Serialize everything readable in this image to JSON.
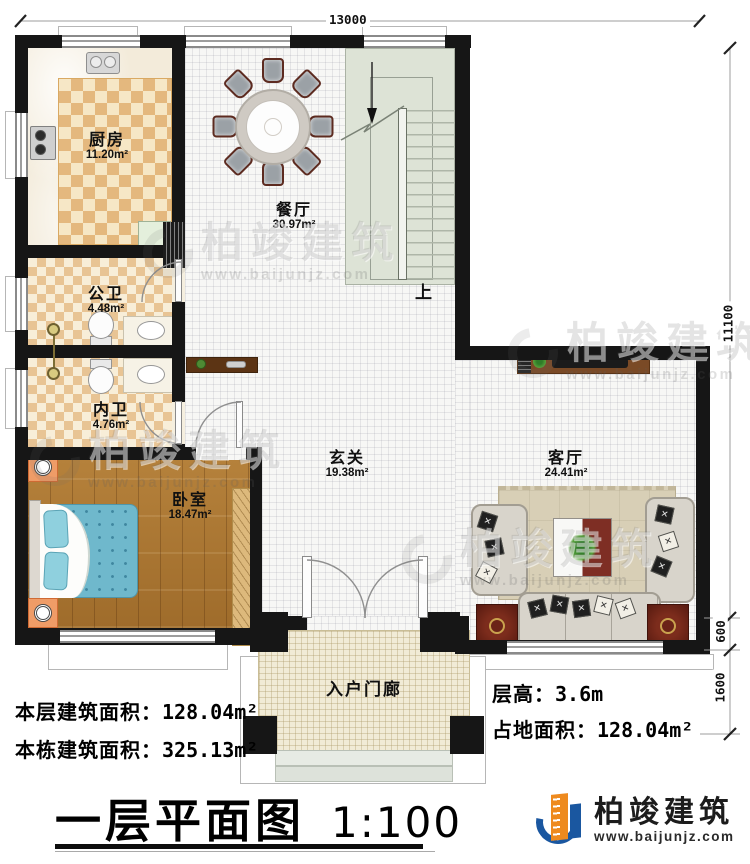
{
  "plan": {
    "title": "一层平面图",
    "scale": "1:100",
    "stair_label": "上",
    "rooms": [
      {
        "name": "厨房",
        "area": "11.20m²"
      },
      {
        "name": "餐厅",
        "area": "30.97m²"
      },
      {
        "name": "公卫",
        "area": "4.48m²"
      },
      {
        "name": "内卫",
        "area": "4.76m²"
      },
      {
        "name": "卧室",
        "area": "18.47m²"
      },
      {
        "name": "玄关",
        "area": "19.38m²"
      },
      {
        "name": "客厅",
        "area": "24.41m²"
      },
      {
        "name": "入户门廊",
        "area": ""
      }
    ],
    "dimensions": {
      "top": "13000",
      "right_main": "11100",
      "right_bay": "600",
      "right_porch": "1600"
    },
    "stats": [
      {
        "label": "本层建筑面积：",
        "value": "128.04m²"
      },
      {
        "label": "本栋建筑面积：",
        "value": "325.13m²"
      },
      {
        "label": "层高：",
        "value": "3.6m"
      },
      {
        "label": "占地面积：",
        "value": "128.04m²"
      }
    ],
    "branding": {
      "company": "柏竣建筑",
      "website": "www.baijunjz.com"
    },
    "watermark": {
      "text": "柏竣建筑",
      "url": "www.baijunjz.com"
    },
    "colors": {
      "wall": "#161616",
      "brand_blue": "#1a57a0",
      "brand_orange": "#ee8a1e"
    }
  }
}
